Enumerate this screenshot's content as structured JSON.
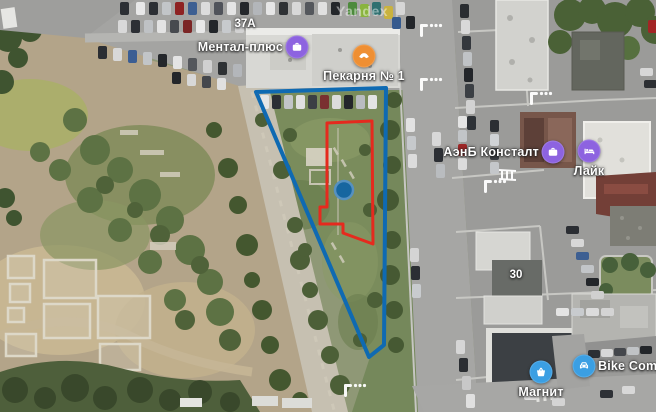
{
  "map": {
    "watermark": "Yandex",
    "pois": [
      {
        "name": "mental-plus",
        "label": "Ментал-плюс",
        "icon": "briefcase",
        "color": "#8d63e0",
        "x": 297,
        "y": 47,
        "label_side": "left"
      },
      {
        "name": "pekarnya-no-1",
        "label": "Пекарня № 1",
        "icon": "bakery",
        "color": "#ef8f33",
        "x": 364,
        "y": 56,
        "label_side": "below"
      },
      {
        "name": "aenb-konstalt",
        "label": "АэнБ Консталт",
        "icon": "briefcase",
        "color": "#8d63e0",
        "x": 553,
        "y": 152,
        "label_side": "left"
      },
      {
        "name": "laik",
        "label": "Лайк",
        "icon": "hotel",
        "color": "#8d63e0",
        "x": 589,
        "y": 151,
        "label_side": "below"
      },
      {
        "name": "magnit",
        "label": "Магнит",
        "icon": "basket",
        "color": "#3b9fe3",
        "x": 541,
        "y": 372,
        "label_side": "below"
      },
      {
        "name": "bike-company",
        "label": "Bike Compan",
        "icon": "car",
        "color": "#3b9fe3",
        "x": 584,
        "y": 366,
        "label_side": "right"
      }
    ],
    "house_numbers": [
      {
        "text": "37А",
        "x": 245,
        "y": 24
      },
      {
        "text": "30",
        "x": 516,
        "y": 275
      }
    ],
    "overlays": {
      "blue_polygon": {
        "color": "#0f6ab2",
        "stroke_width": 4,
        "points": "256,92 386,88 384,345 369,357"
      },
      "red_polygon": {
        "color": "#e52a1e",
        "stroke_width": 3,
        "points": "327,123 372,121 373,244 343,233 343,224 320,224 320,207 327,207"
      },
      "marker": {
        "color": "#1766a0",
        "ring": "#5691c1",
        "x": 344,
        "y": 190,
        "r": 9
      }
    }
  }
}
